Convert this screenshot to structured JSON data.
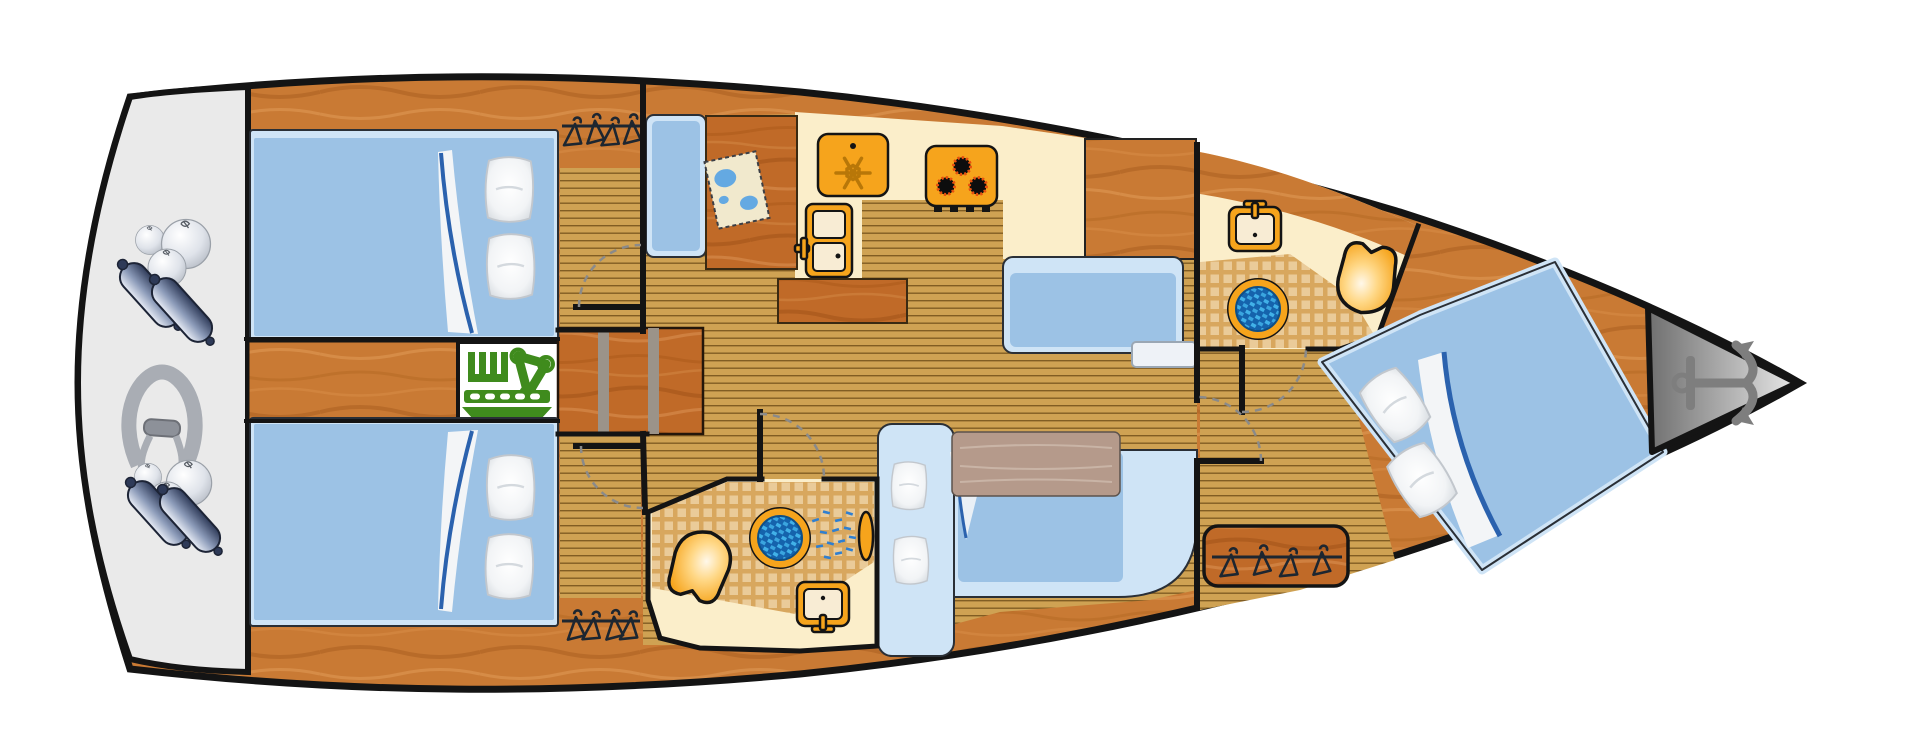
{
  "meta": {
    "image_type": "yacht-interior-deck-plan-top-view",
    "canvas": {
      "width": 1920,
      "height": 756
    },
    "orientation": {
      "stern": "left",
      "bow": "right"
    }
  },
  "rooms": [
    {
      "id": "stern-platform",
      "contents": [
        "fenders",
        "ball-fenders",
        "mooring-rope"
      ]
    },
    {
      "id": "aft-cabin-port",
      "contents": [
        "double-berth",
        "pillows",
        "folded-sheet",
        "wardrobe",
        "entry-door"
      ]
    },
    {
      "id": "engine-compartment",
      "contents": [
        "engine"
      ]
    },
    {
      "id": "companionway",
      "contents": [
        "three-steps"
      ]
    },
    {
      "id": "aft-cabin-starboard",
      "contents": [
        "double-berth",
        "pillows",
        "folded-sheet",
        "wardrobe",
        "entry-door"
      ]
    },
    {
      "id": "galley",
      "contents": [
        "freezer-top-load",
        "stove-three-burners",
        "refrigerator",
        "island-counter"
      ]
    },
    {
      "id": "nav-station",
      "contents": [
        "navigator-seat",
        "chart-table",
        "nautical-map"
      ]
    },
    {
      "id": "salon",
      "contents": [
        "straight-settee",
        "l-shaped-sofa",
        "table",
        "pillows",
        "step"
      ]
    },
    {
      "id": "aft-head",
      "contents": [
        "toilet",
        "shower-drain",
        "shower-spray",
        "sink",
        "door"
      ]
    },
    {
      "id": "forward-head",
      "contents": [
        "sink",
        "shower-drain",
        "toilet",
        "door"
      ]
    },
    {
      "id": "forward-cabin",
      "contents": [
        "angled-double-berth",
        "pillows",
        "folded-sheet",
        "wardrobe",
        "door"
      ]
    },
    {
      "id": "bow-locker",
      "contents": [
        "anchor"
      ]
    }
  ],
  "icon_glossary": {
    "anchor-icon": "anchor stowage at bow",
    "engine-icon": "engine compartment",
    "snowflake-icon": "freezer / cool box",
    "burner-icon": "gas stove burner",
    "hanger-icon": "hanging wardrobe locker",
    "toilet-icon": "marine toilet",
    "shower-drain-icon": "shower floor drain",
    "shower-spray-icon": "shower",
    "sink-icon": "wash basin with faucet",
    "map-icon": "nautical chart on chart table",
    "fender-icon": "boat fender",
    "ball-fender-icon": "round fender buoy",
    "rope-icon": "mooring line coil"
  },
  "palette": {
    "white": "#ffffff",
    "ink": "#141414",
    "wood": "#c97a34",
    "wood_dark": "#a85c1e",
    "wood_light": "#e09b57",
    "wood_furniture": "#c06a28",
    "plank": "#cfa253",
    "plank_line": "#6e4c16",
    "platform": "#eaeaea",
    "cream": "#fbeeca",
    "tile_base": "#d8a75e",
    "tile_light": "#edd0a0",
    "bed": "#9cc2e5",
    "bed_edge": "#cfe4f6",
    "sheet": "#f3f5f7",
    "sheet_line": "#2b62ae",
    "fixture": "#f6a41c",
    "fixture_dark": "#b87708",
    "basin": "#f8ecd4",
    "flame": "#e8500f",
    "engine": "#3f8b1d",
    "drain_blue": "#1563ac",
    "drain_check": "#41b1e8",
    "spray": "#2f7fd0",
    "table": "#b59a8b",
    "riser": "#9b9389",
    "step": "#eef2f7",
    "fender_dark": "#2e3a58",
    "fender_light": "#e9edf6",
    "rope": "#a9adb4",
    "anchor": "#7e7e7e",
    "bow_dark": "#6f6f6f",
    "bow_light": "#e8e8e8",
    "arc": "#8a8a8a",
    "map_paper": "#f1e9cd",
    "map_water": "#64a9e2"
  }
}
